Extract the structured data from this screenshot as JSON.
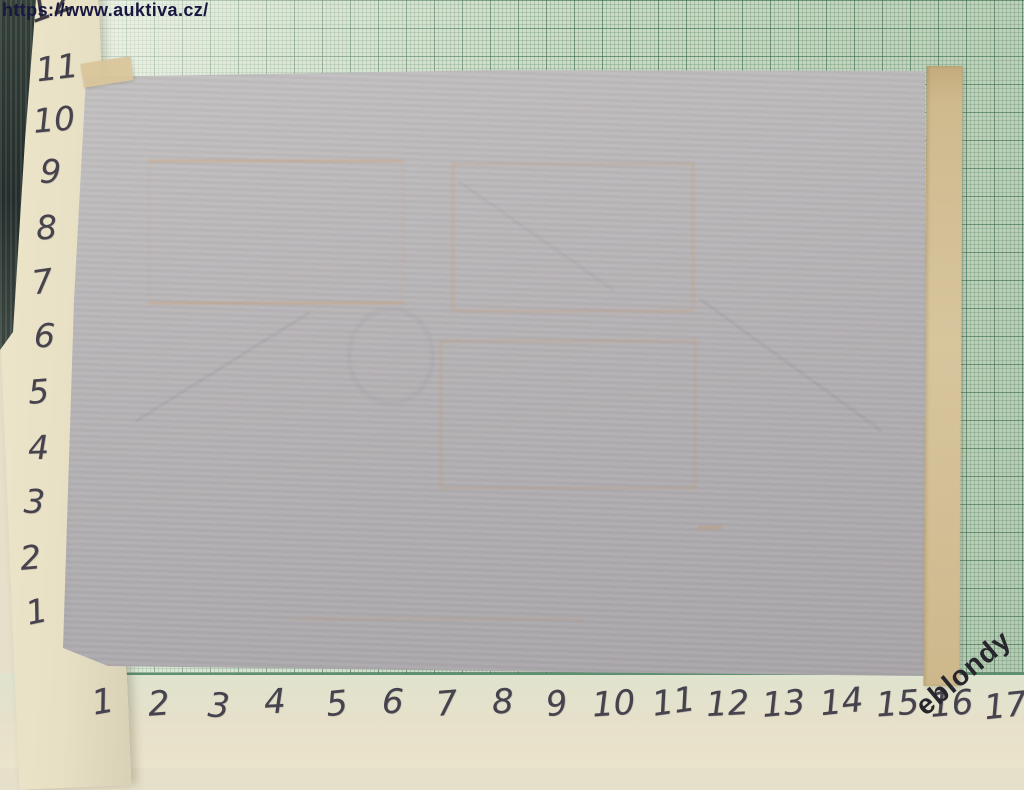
{
  "watermarks": {
    "site_url": "https://www.auktiva.cz/",
    "seller": "eblondy"
  },
  "left_ruler": {
    "partial_top_value": "12",
    "values": [
      "11",
      "10",
      "9",
      "8",
      "7",
      "6",
      "5",
      "4",
      "3",
      "2",
      "1"
    ]
  },
  "bottom_ruler": {
    "values": [
      "1",
      "2",
      "3",
      "4",
      "5",
      "6",
      "7",
      "8",
      "9",
      "10",
      "11",
      "12",
      "13",
      "14",
      "15",
      "16",
      "17"
    ]
  },
  "item": {
    "stamp_ghost_outline_count": 3
  },
  "colors": {
    "graph_paper_green": "#ccdbc6",
    "grid_line_green": "#5d8f70",
    "item_paper_gray": "#b2afb1",
    "album_cream": "#e8e0c4",
    "tape_tan": "#cfba8e",
    "stamp_ghost_orange": "#d09458",
    "watermark_navy": "#171740",
    "seller_watermark_dark": "#26262c",
    "handwriting_gray": "#46424e",
    "dark_edge": "#2b3634"
  }
}
